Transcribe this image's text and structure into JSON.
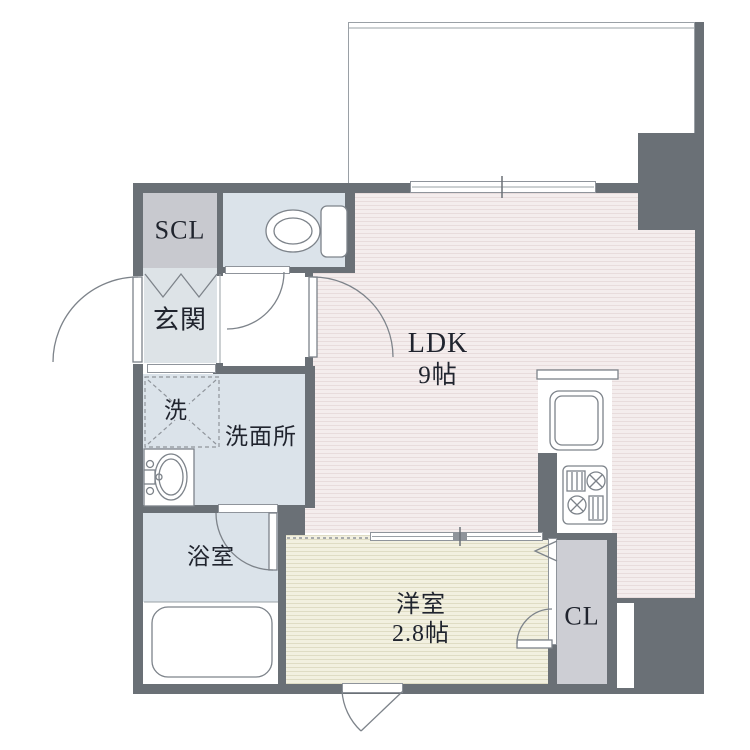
{
  "title": "apartment-floor-plan",
  "colors": {
    "wall": "#6a7076",
    "line": "#8f949b",
    "room_blue": "#dbe3ea",
    "room_gray": "#c8c9cf",
    "genkan": "#dde3e7",
    "ldk_base": "#f4eded",
    "ldk_stripe": "#e8dcdc",
    "bedroom_base": "#f2f0e0",
    "bedroom_stripe": "#dfdcc4",
    "closet_gray": "#cdced4",
    "text": "#20242e"
  },
  "rooms": {
    "scl": {
      "label": "SCL"
    },
    "genkan": {
      "label": "玄関"
    },
    "washer": {
      "label": "洗"
    },
    "washroom": {
      "label": "洗面所"
    },
    "bathroom": {
      "label": "浴室"
    },
    "ldk": {
      "label": "LDK",
      "size": "9帖"
    },
    "bedroom": {
      "label": "洋室",
      "size": "2.8帖"
    },
    "closet": {
      "label": "CL"
    }
  },
  "icons": [
    "toilet-icon",
    "kitchen-sink-icon",
    "stove-icon",
    "vanity-sink-icon",
    "bathtub-icon",
    "washer-pad-icon",
    "door-swing-arc",
    "folding-door-zigzag",
    "sliding-window",
    "sliding-door"
  ]
}
